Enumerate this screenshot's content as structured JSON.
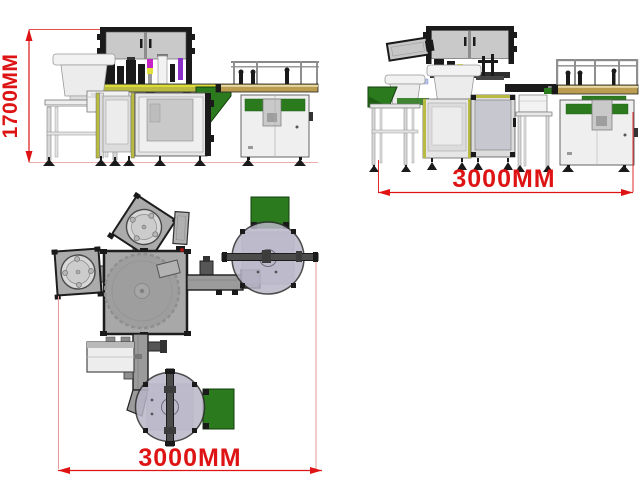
{
  "drawing": {
    "views": {
      "front": {
        "dimension_label": "1700MM"
      },
      "side": {
        "dimension_label": "3000MM"
      },
      "plan": {
        "dimension_label": "3000MM"
      }
    }
  },
  "colors": {
    "background": "#ffffff",
    "dimension": "#de1414",
    "extension": "#e89a9a",
    "frame": "#1a1a1a",
    "cabinet_panel": "#c9c9c9",
    "machine_panel": "#efefef",
    "aluminum": "#dcdcdc",
    "olive": "#b9ba41",
    "belt": "#bb9d52",
    "green": "#2c7a1e",
    "green_dark": "#1e5c14",
    "magenta": "#c425c4",
    "yellow": "#e3df3c",
    "purple": "#8b2fc9",
    "bowl": "#f2f2f2",
    "plan_body": "#a8a8a8",
    "turntable": "#b9b6c8"
  }
}
